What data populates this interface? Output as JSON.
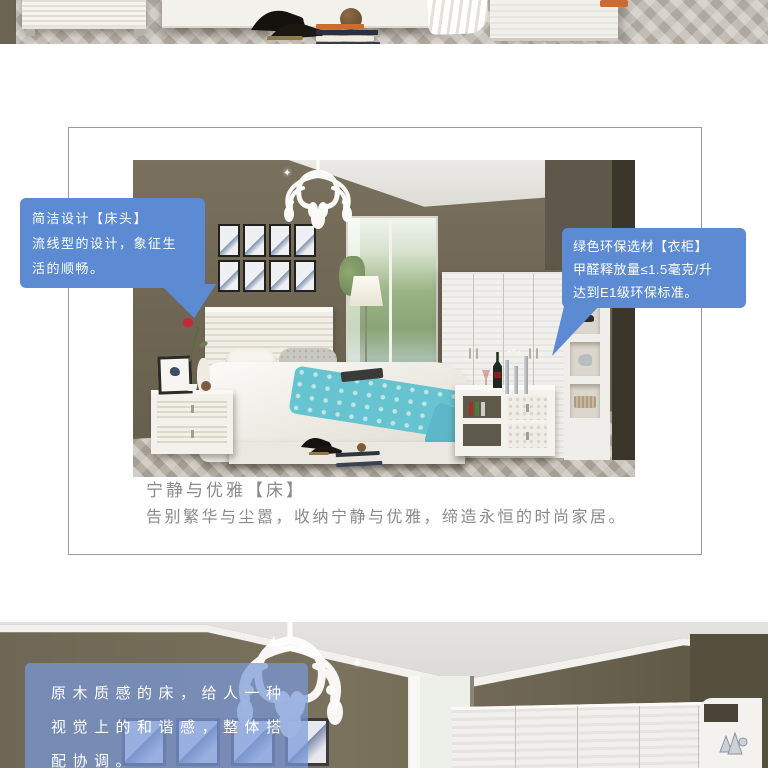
{
  "colors": {
    "bubble_blue": "#5c8bd4",
    "overlay_blue": "rgba(120,152,218,0.72)",
    "caption_gray": "#8a8a8a",
    "panel_border": "#9b9b9b",
    "accent_teal": "#66c3d0",
    "wall_olive": "#6f6754"
  },
  "icons": {
    "sparkle": "✦"
  },
  "bed_section": {
    "headboard_callout": {
      "line1": "简洁设计【床头】",
      "line2": "流线型的设计，象征生",
      "line3": "活的顺畅。"
    },
    "wardrobe_callout": {
      "line1": "绿色环保选材【衣柜】",
      "line2": "甲醛释放量≤1.5毫克/升",
      "line3": "达到E1级环保标准。"
    },
    "caption": {
      "title": "宁静与优雅【床】",
      "body": "告别繁华与尘嚣，收纳宁静与优雅，缔造永恒的时尚家居。"
    }
  },
  "wood_section": {
    "overlay": {
      "line1": "原木质感的床，给人一种",
      "line2": "视觉上的和谐感，整体搭",
      "line3": "配协调。"
    }
  }
}
